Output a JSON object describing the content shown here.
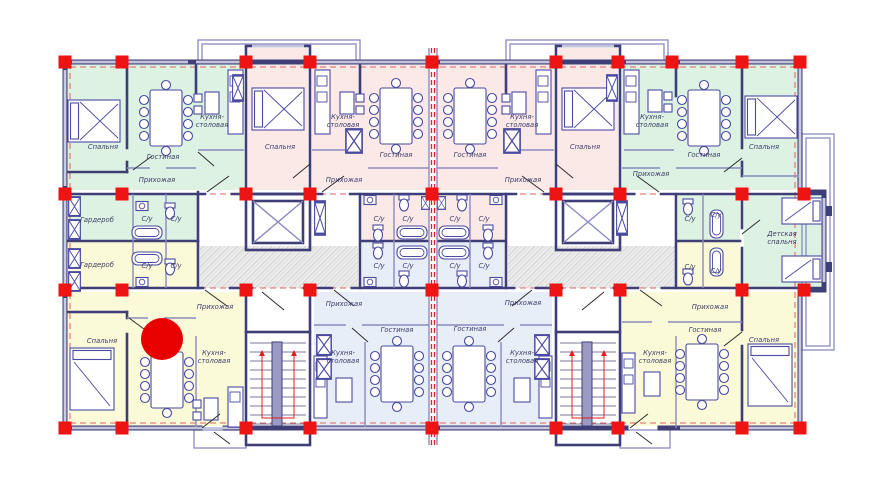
{
  "plan": {
    "type": "apartment-floor-plan",
    "language": "ru"
  },
  "colors": {
    "wall": "#3f3f78",
    "wall-light": "#8a8ac0",
    "furniture": "#4a4aa0",
    "column-red": "#ee1414",
    "dashed-red": "#e06060",
    "stair-red": "#e02020",
    "room-green": "#ddf2e2",
    "room-pink": "#fbe9e8",
    "room-yellow": "#fafad8",
    "room-blue": "#e7eef8",
    "label": "#3c3c66",
    "marker-red": "#e80000"
  },
  "marker": {
    "x": 162,
    "y": 339,
    "r": 21
  },
  "labels": [
    {
      "text": "Спальня",
      "x": 103,
      "y": 149
    },
    {
      "text": "Гостиная",
      "x": 163,
      "y": 159
    },
    {
      "lines": [
        "Кухня-",
        "столовая"
      ],
      "x": 212,
      "y": 119
    },
    {
      "text": "Прихожая",
      "x": 157,
      "y": 182
    },
    {
      "text": "Спальня",
      "x": 280,
      "y": 149
    },
    {
      "lines": [
        "Кухня-",
        "столовая"
      ],
      "x": 343,
      "y": 119
    },
    {
      "text": "Гостиная",
      "x": 396,
      "y": 157
    },
    {
      "text": "Прихожая",
      "x": 344,
      "y": 182
    },
    {
      "text": "Гостиная",
      "x": 470,
      "y": 157
    },
    {
      "lines": [
        "Кухня-",
        "столовая"
      ],
      "x": 522,
      "y": 119
    },
    {
      "text": "Прихожая",
      "x": 523,
      "y": 182
    },
    {
      "text": "Спальня",
      "x": 585,
      "y": 149
    },
    {
      "lines": [
        "Кухня-",
        "столовая"
      ],
      "x": 652,
      "y": 119
    },
    {
      "text": "Гостиная",
      "x": 704,
      "y": 157
    },
    {
      "text": "Спальня",
      "x": 764,
      "y": 149
    },
    {
      "text": "Прихожая",
      "x": 651,
      "y": 176
    },
    {
      "text": "Гардероб",
      "x": 97,
      "y": 222
    },
    {
      "text": "С/у",
      "x": 147,
      "y": 221
    },
    {
      "text": "С/у",
      "x": 176,
      "y": 221
    },
    {
      "text": "Гардероб",
      "x": 97,
      "y": 267
    },
    {
      "text": "С/у",
      "x": 147,
      "y": 268
    },
    {
      "text": "С/у",
      "x": 176,
      "y": 268
    },
    {
      "text": "С/у",
      "x": 379,
      "y": 221
    },
    {
      "text": "С/у",
      "x": 408,
      "y": 221
    },
    {
      "text": "С/у",
      "x": 455,
      "y": 221
    },
    {
      "text": "С/у",
      "x": 484,
      "y": 221
    },
    {
      "text": "С/у",
      "x": 379,
      "y": 268
    },
    {
      "text": "С/у",
      "x": 408,
      "y": 268
    },
    {
      "text": "С/у",
      "x": 455,
      "y": 268
    },
    {
      "text": "С/у",
      "x": 484,
      "y": 268
    },
    {
      "text": "С/у",
      "x": 690,
      "y": 221
    },
    {
      "text": "С/у",
      "x": 716,
      "y": 217
    },
    {
      "text": "С/у",
      "x": 690,
      "y": 269
    },
    {
      "text": "С/у",
      "x": 716,
      "y": 273
    },
    {
      "lines": [
        "Детская",
        "спальня"
      ],
      "x": 782,
      "y": 236
    },
    {
      "text": "Прихожая",
      "x": 215,
      "y": 309
    },
    {
      "text": "Спальня",
      "x": 102,
      "y": 343
    },
    {
      "lines": [
        "Кухня-",
        "столовая"
      ],
      "x": 214,
      "y": 355
    },
    {
      "text": "Прихожая",
      "x": 344,
      "y": 306
    },
    {
      "text": "Гостиная",
      "x": 397,
      "y": 332
    },
    {
      "lines": [
        "Кухня-",
        "столовая"
      ],
      "x": 343,
      "y": 355
    },
    {
      "text": "Гостиная",
      "x": 470,
      "y": 331
    },
    {
      "lines": [
        "Кухня-",
        "столовая"
      ],
      "x": 522,
      "y": 355
    },
    {
      "text": "Прихожая",
      "x": 523,
      "y": 305
    },
    {
      "text": "Прихожая",
      "x": 710,
      "y": 309
    },
    {
      "text": "Гостиная",
      "x": 705,
      "y": 332
    },
    {
      "lines": [
        "Кухня-",
        "столовая"
      ],
      "x": 655,
      "y": 355
    },
    {
      "text": "Спальня",
      "x": 764,
      "y": 342
    }
  ]
}
